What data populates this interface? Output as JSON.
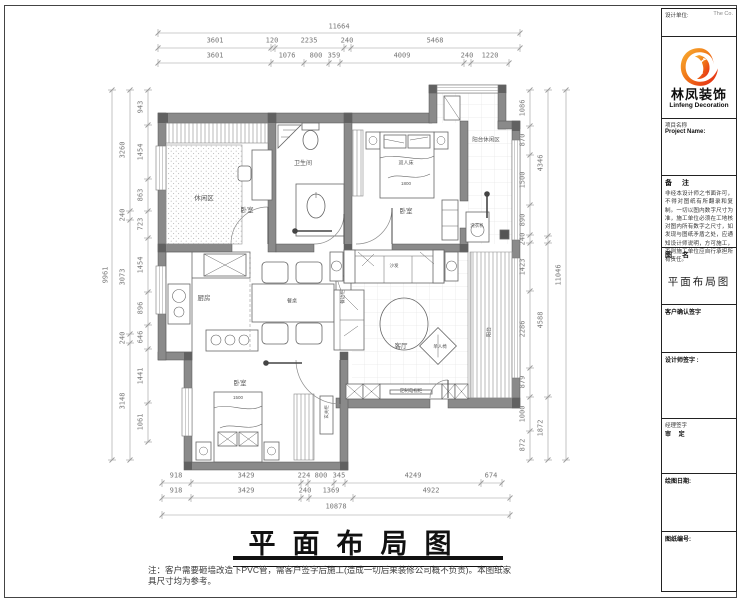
{
  "title_block": {
    "design_unit_label": "设计单位:",
    "corner_text": "The  Co.",
    "logo_cn": "林凤装饰",
    "logo_en": "Linfeng Decoration",
    "project_label_cn": "项目名称",
    "project_label_en": "Project Name:",
    "remark_header": "备  注",
    "remark_body": "非经本设计师之书面许可，不得对图纸有所翻录和复制。一切以图内数字尺寸为准，施工单位必须在工地核对图内所有数字之尺寸，如发现与图纸矛盾之处，应通知设计师说明，方可施工，否则施工单位应自行承担所有责任。",
    "drawing_name_header": "图  名",
    "drawing_name": "平面布局图",
    "client_sign_label": "客户确认签字",
    "designer_sign_label": "设计师签字 :",
    "manager_sign_label": "经理签字",
    "approval_label": "审  定",
    "date_label": "绘图日期:",
    "sheet_no_label": "图纸编号:"
  },
  "plan": {
    "bedroom1": "卧室",
    "tatami": "休闲区",
    "bathroom": "卫生间",
    "bedroom2": "卧室",
    "double_bed": "双人床",
    "bed2_size": "1800",
    "balcony_leisure": "阳台休闲区",
    "washer": "洗衣机",
    "kitchen": "厨房",
    "dining_table": "餐桌",
    "side_cabinet": "餐边柜",
    "living": "客厅",
    "sofa": "沙发",
    "single_chair": "单人椅",
    "balcony": "阳台",
    "tv_cabinet": "定制电视柜",
    "hall_cabinet": "玄关柜",
    "bedroom3": "卧室",
    "bed3_size": "1500"
  },
  "dimensions": {
    "top": {
      "total": "11664",
      "row2": [
        "3601",
        "120",
        "2235",
        "240",
        "5468"
      ],
      "row3": [
        "3601",
        "1076",
        "800",
        "359",
        "4009",
        "240",
        "1220"
      ]
    },
    "left": {
      "total": "9961",
      "mid": [
        "3260",
        "240",
        "3073",
        "240",
        "3148"
      ],
      "inner": [
        "943",
        "1454",
        "863",
        "723",
        "1454",
        "896",
        "646",
        "1441",
        "1061"
      ]
    },
    "right": {
      "total": "11046",
      "mid": [
        "4346",
        "4588",
        "1872"
      ],
      "inner": [
        "1086",
        "870",
        "1500",
        "890",
        "240",
        "1423",
        "2286",
        "879",
        "1000",
        "872"
      ]
    },
    "bottom": {
      "row1": [
        "918",
        "3429",
        "224",
        "800",
        "345",
        "4249",
        "674"
      ],
      "row2": [
        "918",
        "3429",
        "240",
        "1369",
        "4922"
      ],
      "total": "10878"
    }
  },
  "footer": {
    "title": "平面布局图",
    "note": "注：客户需要砸墙改造下PVC管，需客户签字后施工(造成一切后果装修公司概不负责)。本图纸家具尺寸均为参考。"
  }
}
